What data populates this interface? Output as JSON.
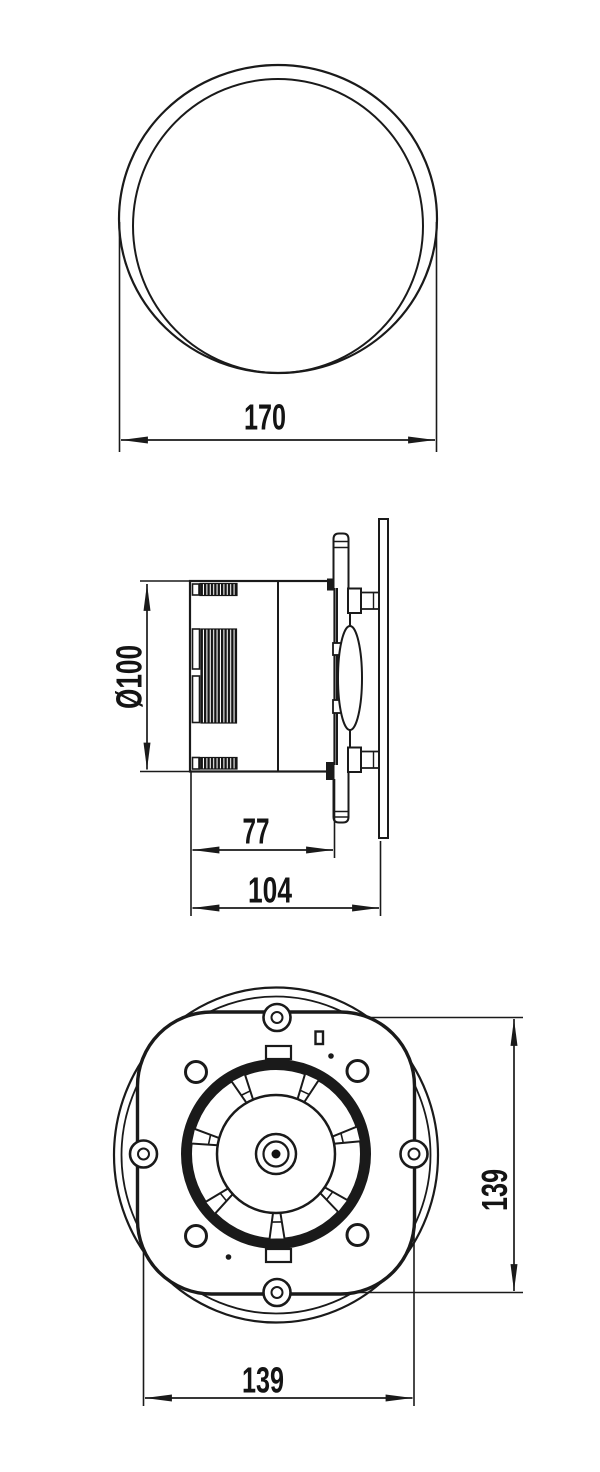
{
  "page": {
    "background": "#ffffff",
    "ink": "#1a1a1a",
    "description": "Three-view dimensioned technical drawing of a round axial duct fan"
  },
  "views": {
    "front": {
      "dims": {
        "width": "170"
      }
    },
    "side": {
      "dims": {
        "diameter": "Ø100",
        "depth_body": "77",
        "depth_total": "104"
      }
    },
    "rear": {
      "blade_count": 7,
      "dims": {
        "bolt_spacing_vertical": "139",
        "bolt_spacing_horizontal": "139"
      }
    }
  }
}
